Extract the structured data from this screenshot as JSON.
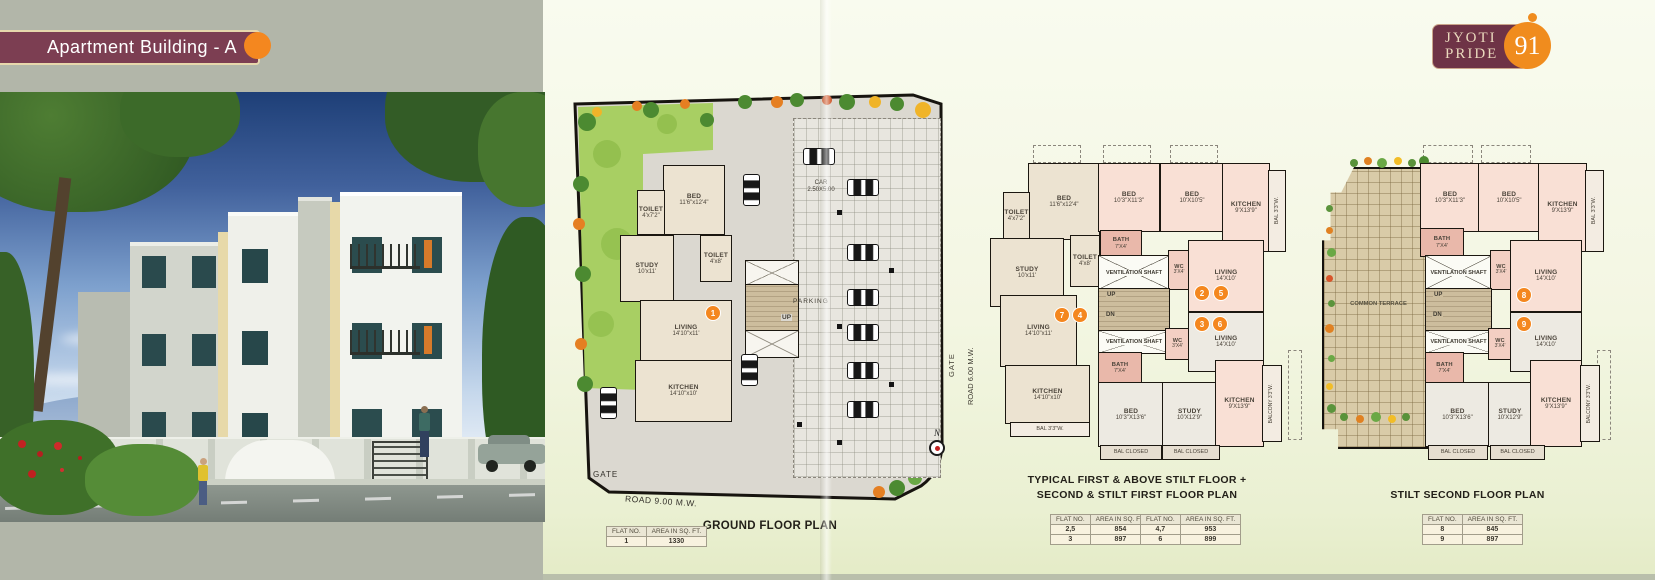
{
  "banner": {
    "title": "Apartment Building - A"
  },
  "logo": {
    "word1": "JYOTI",
    "word2": "PRIDE",
    "number": "91"
  },
  "compass": {
    "n": "N"
  },
  "ground_plan": {
    "caption": "GROUND FLOOR PLAN",
    "road_bottom": "ROAD 9.00 M.W.",
    "road_right": "ROAD 6.00 M.W.",
    "gate_left": "GATE",
    "gate_right": "GATE",
    "parking": "PARKING",
    "car_line1": "CAR",
    "car_line2": "2.50X5.00",
    "up": "UP",
    "badge": "1",
    "rooms": {
      "bed": {
        "name": "BED",
        "dim": "11'6\"x12'4\""
      },
      "toilet1": {
        "name": "TOILET",
        "dim": "4'x7'2\""
      },
      "study": {
        "name": "STUDY",
        "dim": "10'x11'"
      },
      "toilet2": {
        "name": "TOILET",
        "dim": "4'x8'"
      },
      "living": {
        "name": "LIVING",
        "dim": "14'10\"x11'"
      },
      "kitchen": {
        "name": "KITCHEN",
        "dim": "14'10\"x10'"
      }
    },
    "table": {
      "col1": "FLAT NO.",
      "col2": "AREA IN SQ. FT.",
      "rows": [
        [
          "1",
          "1330"
        ]
      ]
    }
  },
  "typical_plan": {
    "caption1": "TYPICAL FIRST & ABOVE STILT FLOOR +",
    "caption2": "SECOND & STILT FIRST FLOOR PLAN",
    "up": "UP",
    "dn": "DN",
    "badges": [
      "7",
      "4",
      "2",
      "5",
      "3",
      "6"
    ],
    "rooms": {
      "bed1": {
        "name": "BED",
        "dim": "11'6\"x12'4\""
      },
      "toilet1": {
        "name": "TOILET",
        "dim": "4'x7'2\""
      },
      "study1": {
        "name": "STUDY",
        "dim": "10'x11'"
      },
      "toilet2": {
        "name": "TOILET",
        "dim": "4'x8'"
      },
      "bed2": {
        "name": "BED",
        "dim": "10'3\"X11'3\""
      },
      "bed3": {
        "name": "BED",
        "dim": "10'X10'5\""
      },
      "kitchen1": {
        "name": "KITCHEN",
        "dim": "9'X13'9\""
      },
      "bal1": {
        "name": "BAL 3'3\"W."
      },
      "bath1": {
        "name": "BATH",
        "dim": "7'X4'"
      },
      "vent1": {
        "name": "VENTILATION SHAFT"
      },
      "wc1": {
        "name": "WC",
        "dim": "3'X4'"
      },
      "living1": {
        "name": "LIVING",
        "dim": "14'X10'"
      },
      "living2": {
        "name": "LIVING",
        "dim": "14'10\"x11'"
      },
      "kitchen2": {
        "name": "KITCHEN",
        "dim": "14'10\"x10'"
      },
      "bal2": {
        "name": "BAL 3'3\"W."
      },
      "vent2": {
        "name": "VENTILATION SHAFT"
      },
      "bath2": {
        "name": "BATH",
        "dim": "7'X4'"
      },
      "wc2": {
        "name": "WC",
        "dim": "3'X4'"
      },
      "living3": {
        "name": "LIVING",
        "dim": "14'X10'"
      },
      "bed4": {
        "name": "BED",
        "dim": "10'3\"X13'6\""
      },
      "study2": {
        "name": "STUDY",
        "dim": "10'X12'9\""
      },
      "kitchen3": {
        "name": "KITCHEN",
        "dim": "9'X13'9\""
      },
      "balcony": {
        "name": "BALCONY 3'3\"W."
      },
      "balclosed1": {
        "name": "BAL CLOSED"
      },
      "balclosed2": {
        "name": "BAL CLOSED"
      }
    },
    "tables": [
      {
        "col1": "FLAT NO.",
        "col2": "AREA IN SQ. FT.",
        "rows": [
          [
            "2,5",
            "854"
          ],
          [
            "3",
            "897"
          ]
        ]
      },
      {
        "col1": "FLAT NO.",
        "col2": "AREA IN SQ. FT.",
        "rows": [
          [
            "4,7",
            "953"
          ],
          [
            "6",
            "899"
          ]
        ]
      }
    ]
  },
  "second_plan": {
    "caption": "STILT SECOND FLOOR PLAN",
    "up": "UP",
    "dn": "DN",
    "badges": [
      "8",
      "9"
    ],
    "terrace": "COMMON TERRACE",
    "rooms": {
      "bed2": {
        "name": "BED",
        "dim": "10'3\"X11'3\""
      },
      "bed3": {
        "name": "BED",
        "dim": "10'X10'5\""
      },
      "kitchen1": {
        "name": "KITCHEN",
        "dim": "9'X13'9\""
      },
      "bal1": {
        "name": "BAL 3'3\"W."
      },
      "bath1": {
        "name": "BATH",
        "dim": "7'X4'"
      },
      "vent1": {
        "name": "VENTILATION SHAFT"
      },
      "wc1": {
        "name": "WC",
        "dim": "3'X4'"
      },
      "living1": {
        "name": "LIVING",
        "dim": "14'X10'"
      },
      "vent2": {
        "name": "VENTILATION SHAFT"
      },
      "bath2": {
        "name": "BATH",
        "dim": "7'X4'"
      },
      "wc2": {
        "name": "WC",
        "dim": "3'X4'"
      },
      "living2": {
        "name": "LIVING",
        "dim": "14'X10'"
      },
      "bed4": {
        "name": "BED",
        "dim": "10'3\"X13'6\""
      },
      "study2": {
        "name": "STUDY",
        "dim": "10'X12'9\""
      },
      "kitchen3": {
        "name": "KITCHEN",
        "dim": "9'X13'9\""
      },
      "balcony": {
        "name": "BALCONY 3'3\"W."
      },
      "balclosed1": {
        "name": "BAL CLOSED"
      },
      "balclosed2": {
        "name": "BAL CLOSED"
      }
    },
    "table": {
      "col1": "FLAT NO.",
      "col2": "AREA IN SQ. FT.",
      "rows": [
        [
          "8",
          "845"
        ],
        [
          "9",
          "897"
        ]
      ]
    }
  }
}
